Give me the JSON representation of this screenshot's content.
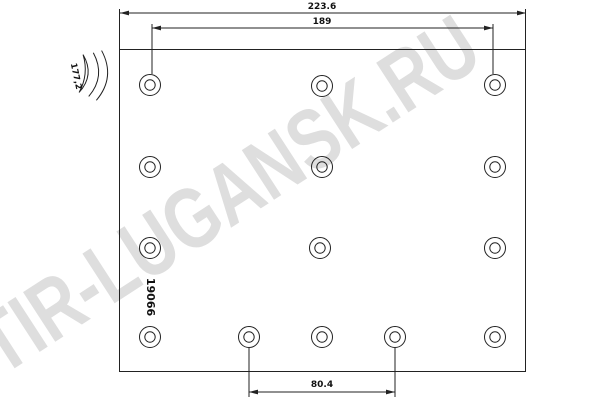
{
  "watermark": "TIR-LUGANSK.RU",
  "part_number": "19066",
  "dimensions": {
    "overall_width": "223.6",
    "top_hole_span": "189",
    "bottom_hole_span": "80.4",
    "arc_width": "177,2"
  },
  "colors": {
    "line": "#222222",
    "watermark": "#dedede",
    "background": "#ffffff",
    "text": "#111111"
  }
}
